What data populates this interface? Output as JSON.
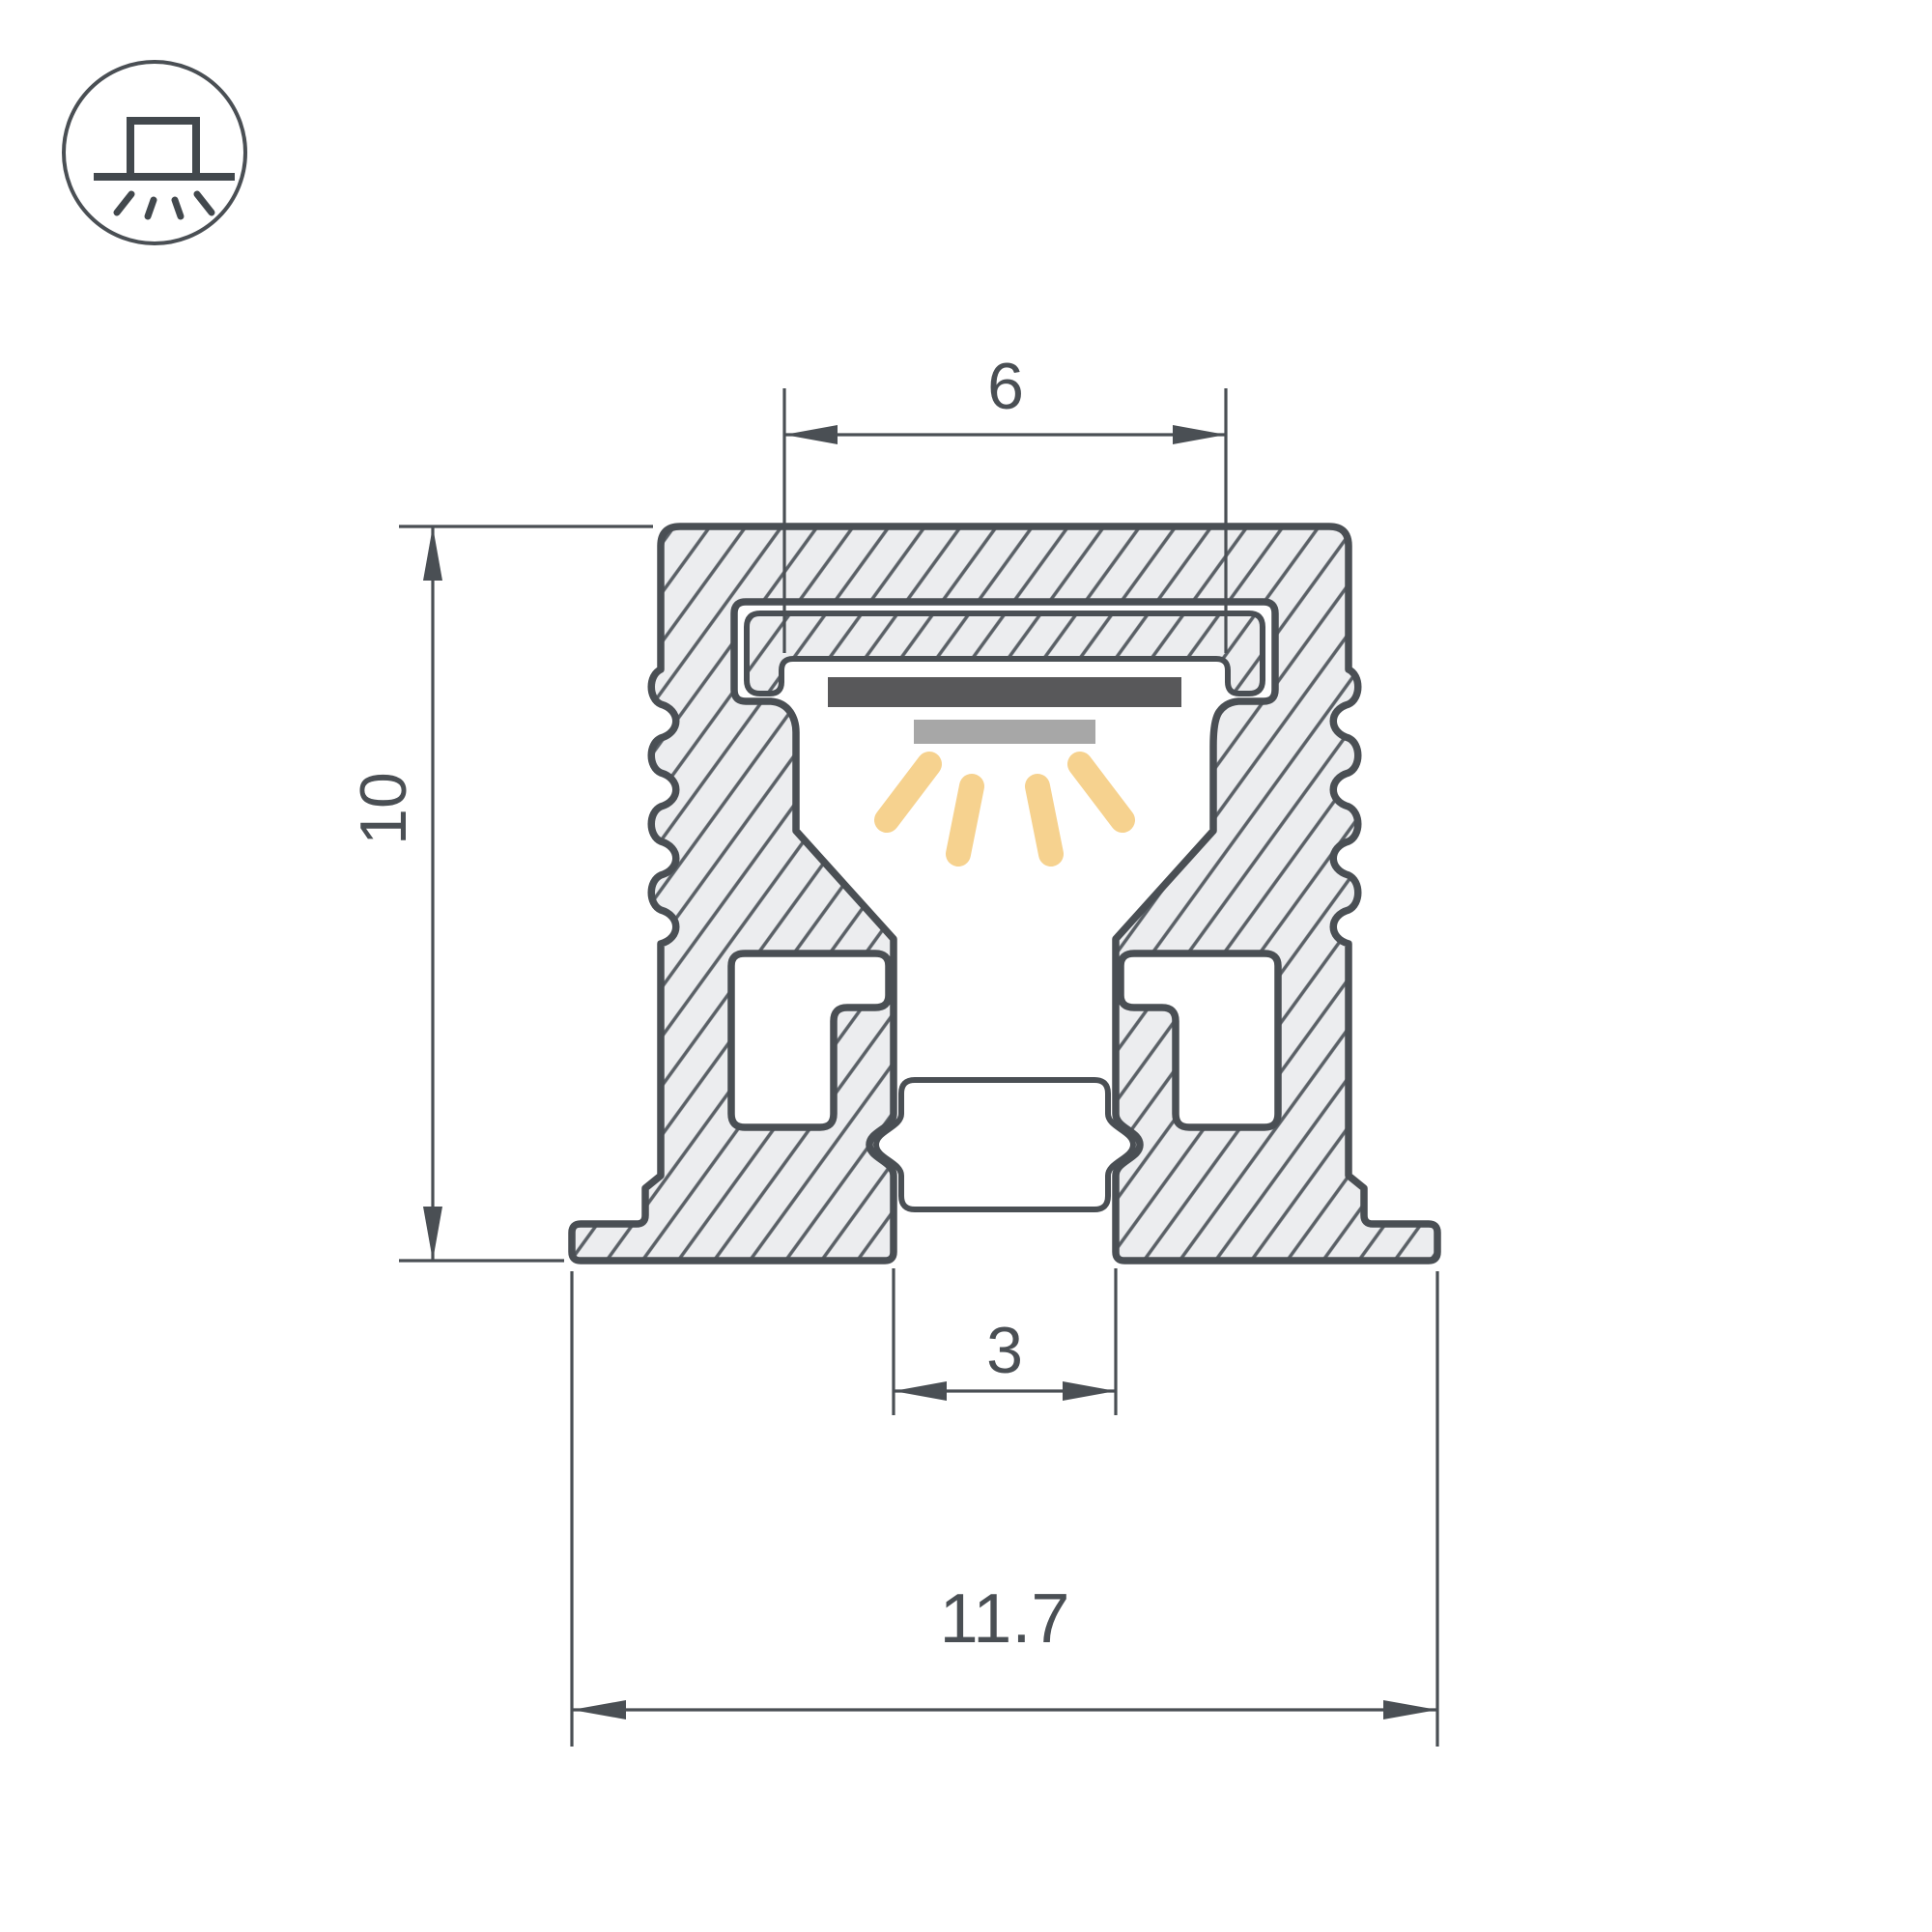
{
  "drawing": {
    "title": "led-profile-cross-section",
    "dimensions": {
      "top_width": {
        "value": "6"
      },
      "height": {
        "value": "10"
      },
      "bottom_slot": {
        "value": "3"
      },
      "overall_width": {
        "value": "11.7"
      }
    },
    "icon": {
      "name": "surface-mount-light-down-icon"
    },
    "colors": {
      "outline": "#4a4f54",
      "aluminum_fill": "#ecedef",
      "hatch_line": "#5a6066",
      "led_strip_dark": "#58585a",
      "led_emitter_gray": "#a7a7a7",
      "light_ray": "#f6d28f",
      "background": "#ffffff"
    }
  }
}
